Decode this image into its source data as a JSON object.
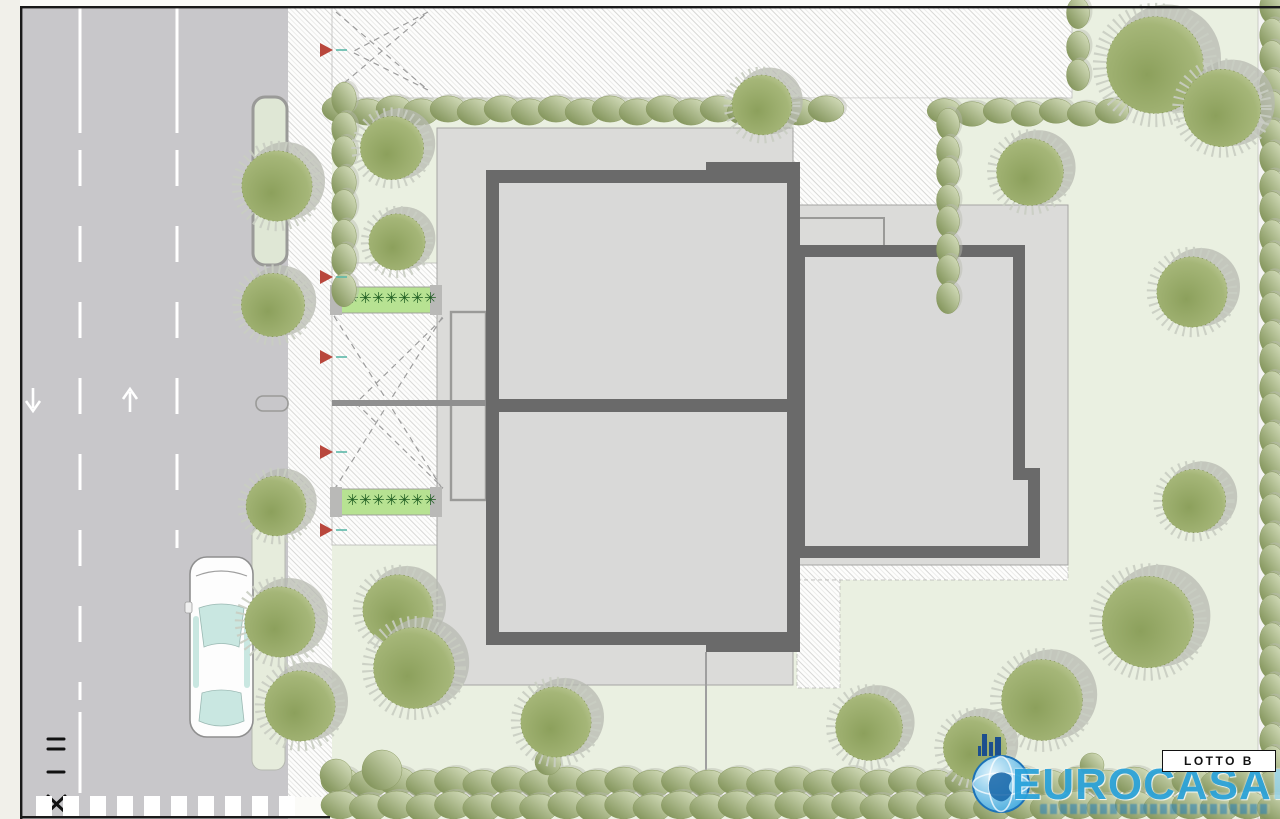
{
  "title": "Planimetria lotto B",
  "labels": {
    "lotto_badge": "LOTTO B"
  },
  "logo": {
    "brand": "EUROCASA",
    "suffix": "IMM",
    "suffix_clipped": "M",
    "icon": "globe-skyline-icon"
  },
  "colors": {
    "road": "#c8c7ca",
    "lawn": "#eaf0e1",
    "plot": "#dbdbd9",
    "wall": "#6a6a6a",
    "building_fill": "#d9d9d8",
    "island": "#dfe7d5",
    "hedge_dark": "#76894c",
    "hedge_light": "#dde5c6",
    "tree_dark": "#8ca05c",
    "tree_light": "#c6d1a2",
    "canopy_shadow": "#b7bab0",
    "planting_strip": "#b7e292",
    "plant_green": "#1d5c20",
    "marker_red": "#b9473c",
    "car_glass": "#c9e7e1",
    "logo_blue": "#2aa3dc",
    "logo_blue_light": "#9ad9f4",
    "logo_navy": "#1c4f8e",
    "hatch_line": "#d8d8d6",
    "frame": "#1a1a1a",
    "margin": "#f1f0ea"
  },
  "plan": {
    "trees": [
      [
        277,
        186,
        40
      ],
      [
        273,
        305,
        36
      ],
      [
        392,
        148,
        36
      ],
      [
        397,
        242,
        32
      ],
      [
        276,
        506,
        34
      ],
      [
        280,
        622,
        40
      ],
      [
        300,
        706,
        40
      ],
      [
        398,
        610,
        40
      ],
      [
        414,
        668,
        46
      ],
      [
        556,
        722,
        40
      ],
      [
        762,
        105,
        34
      ],
      [
        869,
        727,
        38
      ],
      [
        975,
        748,
        36
      ],
      [
        1042,
        700,
        46
      ],
      [
        1148,
        622,
        52
      ],
      [
        1194,
        501,
        36
      ],
      [
        1192,
        292,
        40
      ],
      [
        1030,
        172,
        38
      ],
      [
        1155,
        65,
        55
      ],
      [
        1222,
        108,
        44
      ]
    ],
    "hedges": [
      [
        340,
        110,
        826,
        110,
        16,
        27
      ],
      [
        944,
        112,
        1112,
        112,
        15,
        26
      ],
      [
        948,
        125,
        948,
        296,
        14,
        24
      ],
      [
        344,
        100,
        344,
        288,
        15,
        25
      ],
      [
        1078,
        14,
        1078,
        76,
        14,
        22
      ],
      [
        1272,
        8,
        1272,
        814,
        15,
        25
      ],
      [
        340,
        782,
        1276,
        782,
        17,
        28
      ],
      [
        340,
        806,
        1276,
        806,
        17,
        28
      ]
    ],
    "shrubs": [
      [
        382,
        770,
        20
      ],
      [
        548,
        762,
        13
      ],
      [
        1092,
        765,
        12
      ],
      [
        336,
        775,
        16
      ]
    ],
    "markers": [
      [
        320,
        50
      ],
      [
        320,
        277
      ],
      [
        320,
        357
      ],
      [
        320,
        452
      ],
      [
        320,
        530
      ]
    ],
    "strips": [
      [
        332,
        287,
        106,
        26
      ],
      [
        332,
        489,
        106,
        26
      ]
    ],
    "plant_glyph": "✳",
    "road_symbols": [
      "equals",
      "dash",
      "cross"
    ],
    "arrows": [
      "arrow-down",
      "arrow-up"
    ]
  }
}
